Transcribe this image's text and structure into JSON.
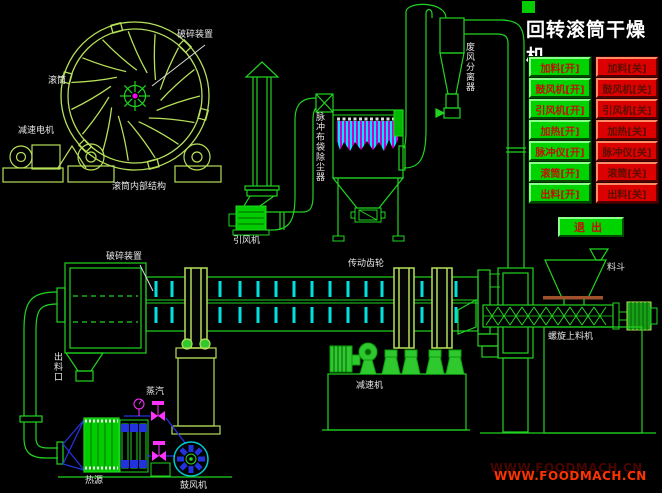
{
  "header": {
    "title": "回转滚筒干燥机"
  },
  "control_panel": {
    "on_buttons": [
      "加料[开]",
      "鼓风机[开]",
      "引风机[开]",
      "加热[开]",
      "脉冲仪[开]",
      "滚筒[开]",
      "出料[开]"
    ],
    "off_buttons": [
      "加料[关]",
      "鼓风机[关]",
      "引风机[关]",
      "加热[关]",
      "脉冲仪[关]",
      "滚筒[关]",
      "出料[关]"
    ],
    "exit_label": "退出"
  },
  "diagram_labels": {
    "crusher_wheel": "破碎装置",
    "drum_wheel": "滚筒",
    "gear_motor": "减速电机",
    "drum_internal": "滚筒内部结构",
    "dust_collector": "脉冲布袋除尘器",
    "induced_fan": "引风机",
    "cyclone": "废风分离器",
    "crusher_drum": "破碎装置",
    "drive_gear": "传动齿轮",
    "reducer": "减速机",
    "hopper": "料斗",
    "screw_feeder": "螺旋上料机",
    "discharge_port": "出料口",
    "steam": "蒸汽",
    "heat_source": "热源",
    "blower": "鼓风机"
  },
  "watermark": "WWW.FOODMACH.CN",
  "colors": {
    "line_green": "#21d421",
    "machine_green": "#b6e05a",
    "blade_cyan": "#00e0e0",
    "bag_magenta": "#cc00cc",
    "valve_magenta": "#ff33ff",
    "pipe_blue": "#2233dd",
    "button_on_green": "#00d400",
    "button_off_red": "#dd0000",
    "button_text_red": "#c40f00",
    "watermark_red": "#ff3300",
    "material_brown": "#a0522d"
  }
}
